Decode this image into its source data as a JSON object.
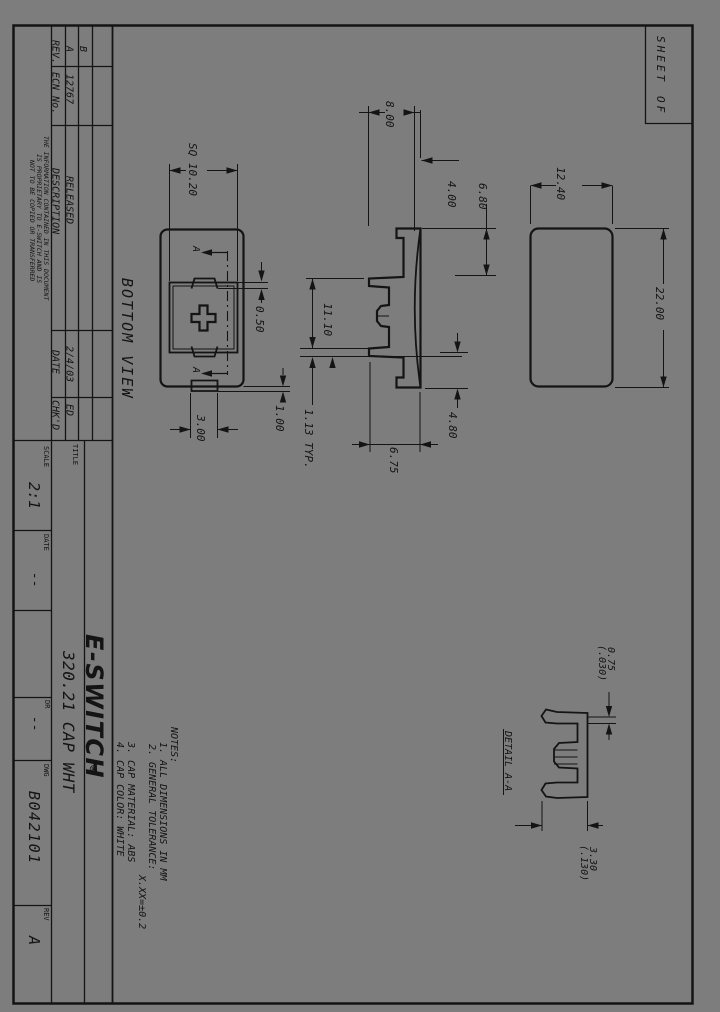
{
  "sheet": {
    "background": "#7d7d7d",
    "ink": "#141414",
    "sheet_label_1": "SHEET",
    "sheet_label_2": "OF"
  },
  "rev_table": {
    "headers": {
      "rev": "REV.",
      "ecn": "ECN No.",
      "description": "DESCRIPTION",
      "date": "DATE",
      "chkd": "CHK'D"
    },
    "row_b": {
      "rev": "B"
    },
    "row_a": {
      "rev": "A",
      "ecn": "12767",
      "description": "RELEASED",
      "date": "2/4/03",
      "chkd": "ED"
    }
  },
  "proprietary_note": {
    "line1": "THE INFORMATION CONTAINED IN THIS DOCUMENT",
    "line2": "IS PROPRIETARY TO E-SWITCH AND IS",
    "line3": "NOT TO BE COPIED OR TRANSFERRED"
  },
  "title_block": {
    "title_label": "TITLE",
    "part_title": "320.21 CAP WHT",
    "logo": "E-SWITCH",
    "logo_reg": "®",
    "scale_label": "SCALE",
    "scale_value": "2:1",
    "date_label": "DATE",
    "date_value": "--",
    "dr_label": "DR",
    "dr_value": "--",
    "dwg_label": "DWG",
    "dwg_value": "B042101",
    "rev_label": "REV",
    "rev_value": "A"
  },
  "notes": {
    "heading": "NOTES:",
    "note1": "1. ALL DIMENSIONS IN MM",
    "note2": "2. GENERAL TOLERANCE:",
    "note2_value": "X.XX=±0.2",
    "note3": "3. CAP MATERIAL: ABS",
    "note4": "4. CAP COLOR: WHITE"
  },
  "views": {
    "bottom_view_label": "BOTTOM VIEW",
    "detail_label": "DETAIL A-A",
    "section_flag": "A"
  },
  "dims": {
    "sq": "SQ 10.20",
    "d_050": "0.50",
    "d_300": "3.00",
    "d_100": "1.00",
    "d_800": "8.00",
    "d_400": "4.00",
    "d_680": "6.80",
    "d_1110": "11.10",
    "d_113_typ": "1.13 TYP.",
    "d_675": "6.75",
    "d_480": "4.80",
    "d_1240": "12.40",
    "d_2200": "22.00",
    "d_075": "0.75",
    "d_075_in": "(.030)",
    "d_330": "3.30",
    "d_330_in": "(.130)"
  }
}
